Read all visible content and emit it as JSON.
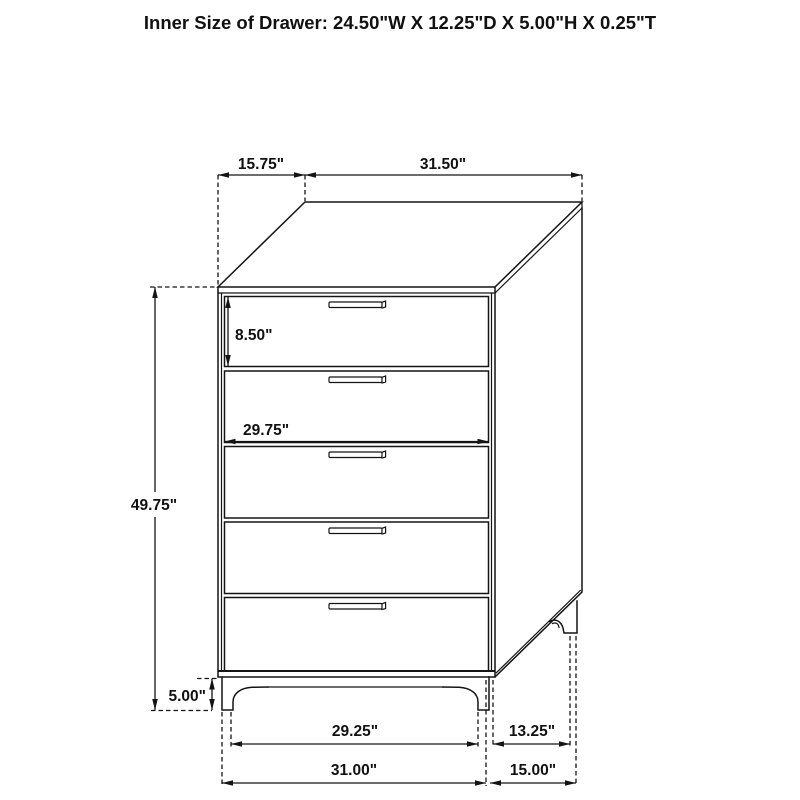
{
  "title": "Inner Size of Drawer: 24.50\"W X 12.25\"D X 5.00\"H X 0.25\"T",
  "figure": {
    "type": "furniture-dimension-diagram",
    "drawer_count": 5
  },
  "dimensions": {
    "top_depth": "15.75\"",
    "top_width": "31.50\"",
    "top_drawer_height": "8.50\"",
    "drawer_inner_width": "29.75\"",
    "overall_height": "49.75\"",
    "leg_height": "5.00\"",
    "front_legs_span": "29.25\"",
    "side_legs_span": "13.25\"",
    "base_width": "31.00\"",
    "base_depth": "15.00\""
  }
}
